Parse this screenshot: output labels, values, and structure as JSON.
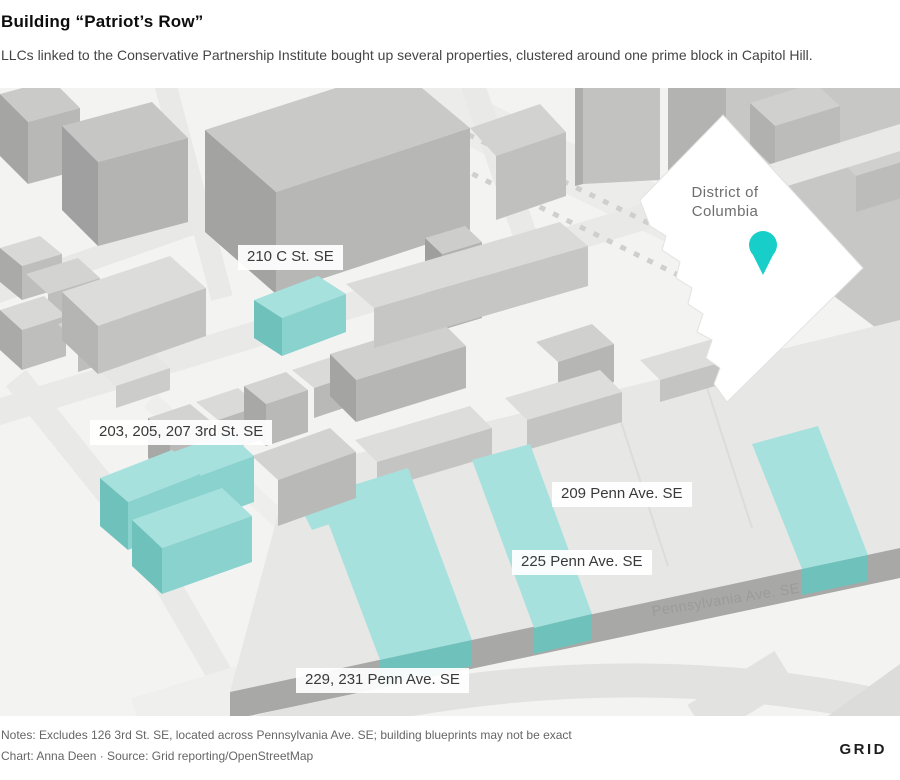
{
  "header": {
    "title": "Building “Patriot’s Row”",
    "subtitle": "LLCs linked to the Conservative Partnership Institute bought up several properties, clustered around one prime block in Capitol Hill."
  },
  "map": {
    "building_labels": [
      {
        "text": "210 C St. SE"
      },
      {
        "text": "203, 205, 207 3rd St. SE"
      },
      {
        "text": "209 Penn Ave. SE"
      },
      {
        "text": "225 Penn Ave. SE"
      },
      {
        "text": "229, 231 Penn Ave. SE"
      }
    ],
    "street_label": "Pennsylvania Ave. SE",
    "inset": {
      "region_line1": "District of",
      "region_line2": "Columbia"
    },
    "colors": {
      "highlight_top": "#a7e1de",
      "highlight_front": "#8ad2ce",
      "highlight_side": "#6fc2bc",
      "pin": "#17cfc8"
    }
  },
  "footer": {
    "notes": "Notes: Excludes 126 3rd St. SE, located across Pennsylvania Ave. SE; building blueprints may not be exact",
    "credit": "Chart: Anna Deen · Source: Grid reporting/OpenStreetMap",
    "logo": "GRID"
  }
}
